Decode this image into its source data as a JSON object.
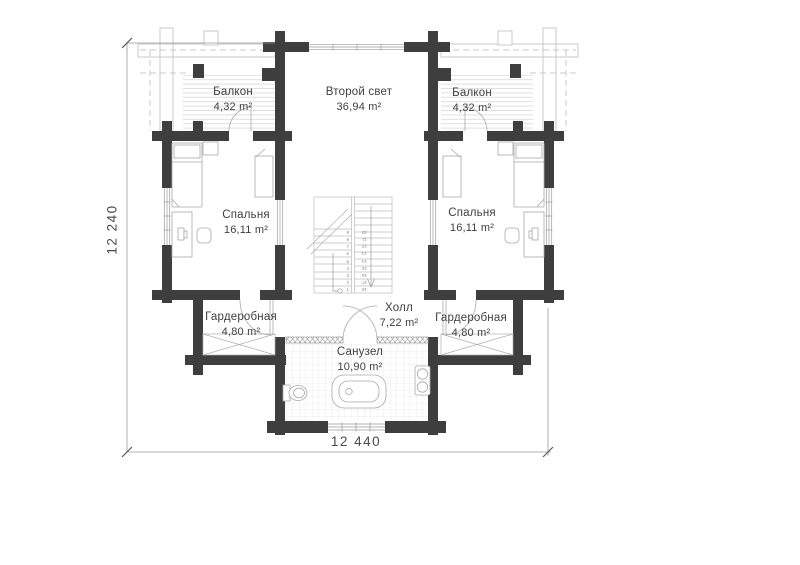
{
  "plan": {
    "rooms": [
      {
        "id": "balcony-left",
        "name": "Балкон",
        "area": "4,32 m²"
      },
      {
        "id": "second-light",
        "name": "Второй свет",
        "area": "36,94 m²"
      },
      {
        "id": "balcony-right",
        "name": "Балкон",
        "area": "4,32 m²"
      },
      {
        "id": "bedroom-left",
        "name": "Спальня",
        "area": "16,11 m²"
      },
      {
        "id": "bedroom-right",
        "name": "Спальня",
        "area": "16,11 m²"
      },
      {
        "id": "wardrobe-left",
        "name": "Гардеробная",
        "area": "4,80 m²"
      },
      {
        "id": "hall",
        "name": "Холл",
        "area": "7,22 m²"
      },
      {
        "id": "wardrobe-right",
        "name": "Гардеробная",
        "area": "4,80 m²"
      },
      {
        "id": "bathroom",
        "name": "Санузел",
        "area": "10,90 m²"
      }
    ],
    "dimensions": {
      "width_label": "12 440",
      "height_label": "12 240"
    },
    "stairs": {
      "left": [
        "9",
        "8",
        "7",
        "6",
        "5",
        "4",
        "3",
        "2",
        "1"
      ],
      "right": [
        "10",
        "11",
        "12",
        "13",
        "14",
        "15",
        "16",
        "17",
        "18"
      ]
    },
    "colors": {
      "wall": "#3e3e3e",
      "line": "#9a9a9a",
      "light_line": "#c8c8c8",
      "text": "#3f3f3f"
    }
  }
}
